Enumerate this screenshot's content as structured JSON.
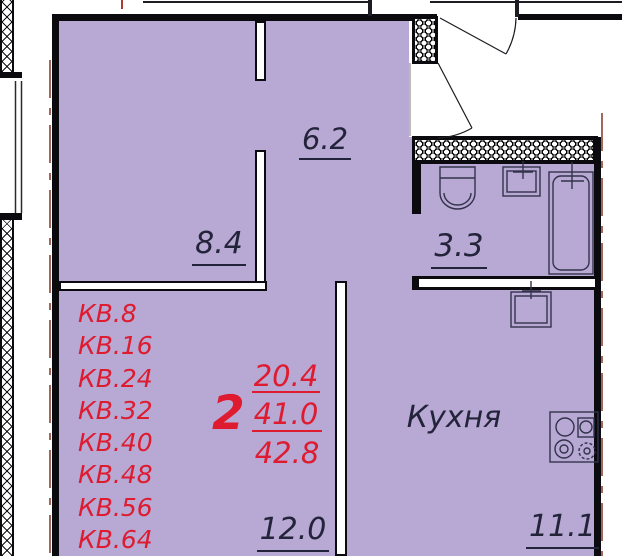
{
  "plan": {
    "apartments": [
      "КВ.8",
      "КВ.16",
      "КВ.24",
      "КВ.32",
      "КВ.40",
      "КВ.48",
      "КВ.56",
      "КВ.64"
    ],
    "summary": {
      "rooms_count": "2",
      "living_area": "20.4",
      "floor_area": "41.0",
      "total_area": "42.8"
    },
    "rooms": {
      "hallway": {
        "area": "6.2"
      },
      "bedroom": {
        "area": "8.4"
      },
      "bathroom": {
        "area": "3.3"
      },
      "living": {
        "area": "12.0"
      },
      "kitchen": {
        "label": "Кухня",
        "area": "11.1"
      }
    },
    "colors": {
      "room_fill": "#b7a8d4",
      "accent_red": "#de1b2f",
      "label_ink": "#23233a",
      "dimension_line": "#8a4330",
      "wall": "#0b0b0f"
    }
  }
}
